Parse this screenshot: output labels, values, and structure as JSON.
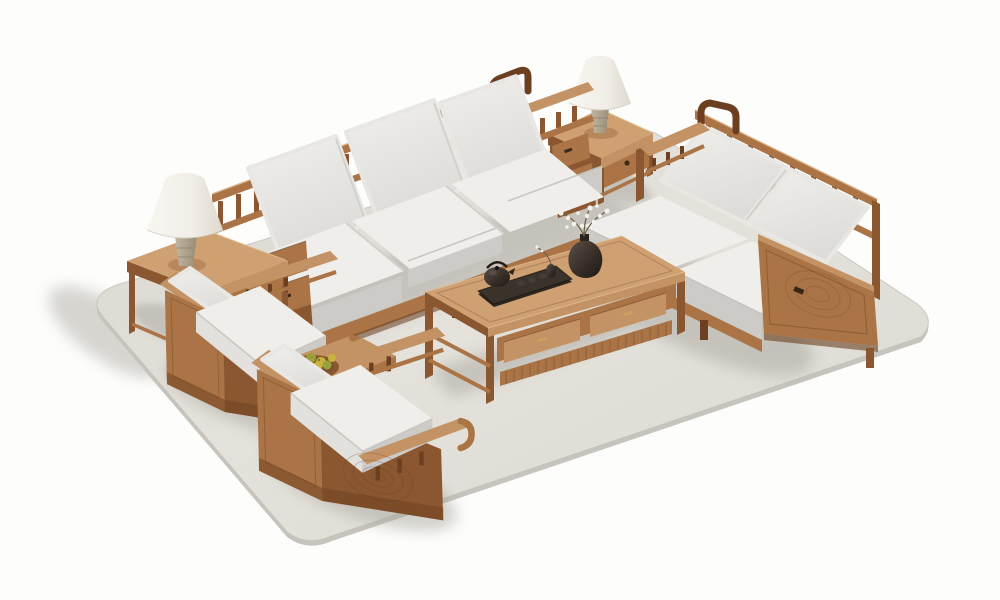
{
  "scene": {
    "subject": "wooden-living-room-furniture-set-product-render",
    "items": [
      {
        "name": "area-rug",
        "shape": "rounded-rectangle-isometric"
      },
      {
        "name": "three-seat-sofa",
        "back_cushions": 3,
        "seat_cushions": 3,
        "arm_drawers": 4,
        "back_style": "spindle-rail"
      },
      {
        "name": "loveseat",
        "back_cushions": 2,
        "seat_cushions": 2,
        "side_panel": "ring-carved",
        "pulls": 1
      },
      {
        "name": "armchair-upper",
        "cushions": 2,
        "back_style": "spindle-rail"
      },
      {
        "name": "armchair-lower",
        "cushions": 2,
        "side_panel": "spiral-carved"
      },
      {
        "name": "coffee-table",
        "drawers": 2,
        "pulls": "brass",
        "shelf": "slatted",
        "accessories": [
          "tea-tray",
          "teapot",
          "tea-cups-x3",
          "bud-vase",
          "flower-vase-white-blossoms"
        ]
      },
      {
        "name": "side-table-top",
        "drawer_knobs": 1,
        "accessory": "table-lamp"
      },
      {
        "name": "side-table-left",
        "drawer_knobs": 1,
        "accessory": "table-lamp"
      },
      {
        "name": "table-lamp",
        "count": 2,
        "shade": "white-cone",
        "base": "travertine"
      },
      {
        "name": "fruit-tray",
        "fruits": 7,
        "fruit_type": "loquat-yellow"
      }
    ]
  },
  "colors": {
    "bg": "#fdfdfc",
    "rug-light": "#e6e4dd",
    "rug-mid": "#dedcd4",
    "rug-dark": "#cfcdc5",
    "rug-side": "#c6c4bc",
    "shadow": "#a8a69d",
    "wood-hi": "#dfb88c",
    "wood-top": "#cfa071",
    "wood-light": "#c49365",
    "wood-mid": "#aa7446",
    "wood-dark": "#8a5731",
    "wood-deep": "#6b3f20",
    "cushion-light": "#efeeea",
    "cushion-mid": "#e2e1dd",
    "cushion-dark": "#cccbc7",
    "cushion-deep": "#b9b8b4",
    "stone": "#b9ad99",
    "stone-dark": "#938872",
    "dark-obj": "#2e2720",
    "dark-obj2": "#463c32",
    "blossom": "#f4f1ec",
    "fruit": "#c9b23e",
    "fruit2": "#9ba03a",
    "brass": "#caa05c"
  }
}
